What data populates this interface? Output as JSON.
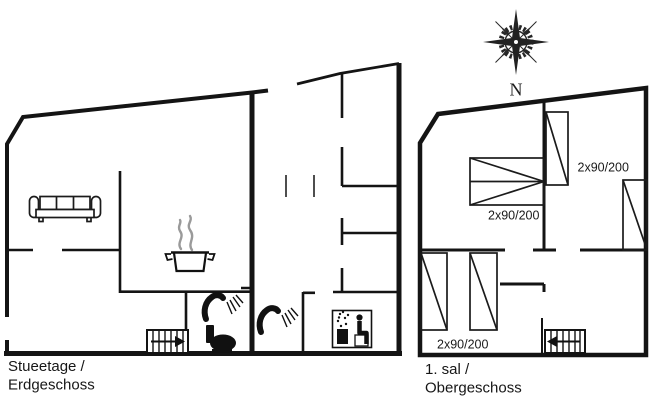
{
  "image": {
    "type": "holiday-home floor plan drawing",
    "background": "#ffffff"
  },
  "colors": {
    "ink": "#1a1a1a",
    "steam": "#9a9a9a"
  },
  "compass": {
    "north_label": "N"
  },
  "ground_floor": {
    "title_line1": "Stueetage /",
    "title_line2": "Erdgeschoss",
    "icons": [
      "sofa",
      "steaming-pot",
      "stairs-up-arrow",
      "shower-head",
      "toilet",
      "shower-head",
      "sauna"
    ]
  },
  "upper_floor": {
    "title_line1": "1. sal /",
    "title_line2": "Obergeschoss",
    "bed_labels": [
      "2x90/200",
      "2x90/200",
      "2x90/200"
    ],
    "icons": [
      "bunk-bed",
      "double-bed",
      "bed",
      "bed",
      "bed",
      "stairs-down-arrow"
    ]
  }
}
